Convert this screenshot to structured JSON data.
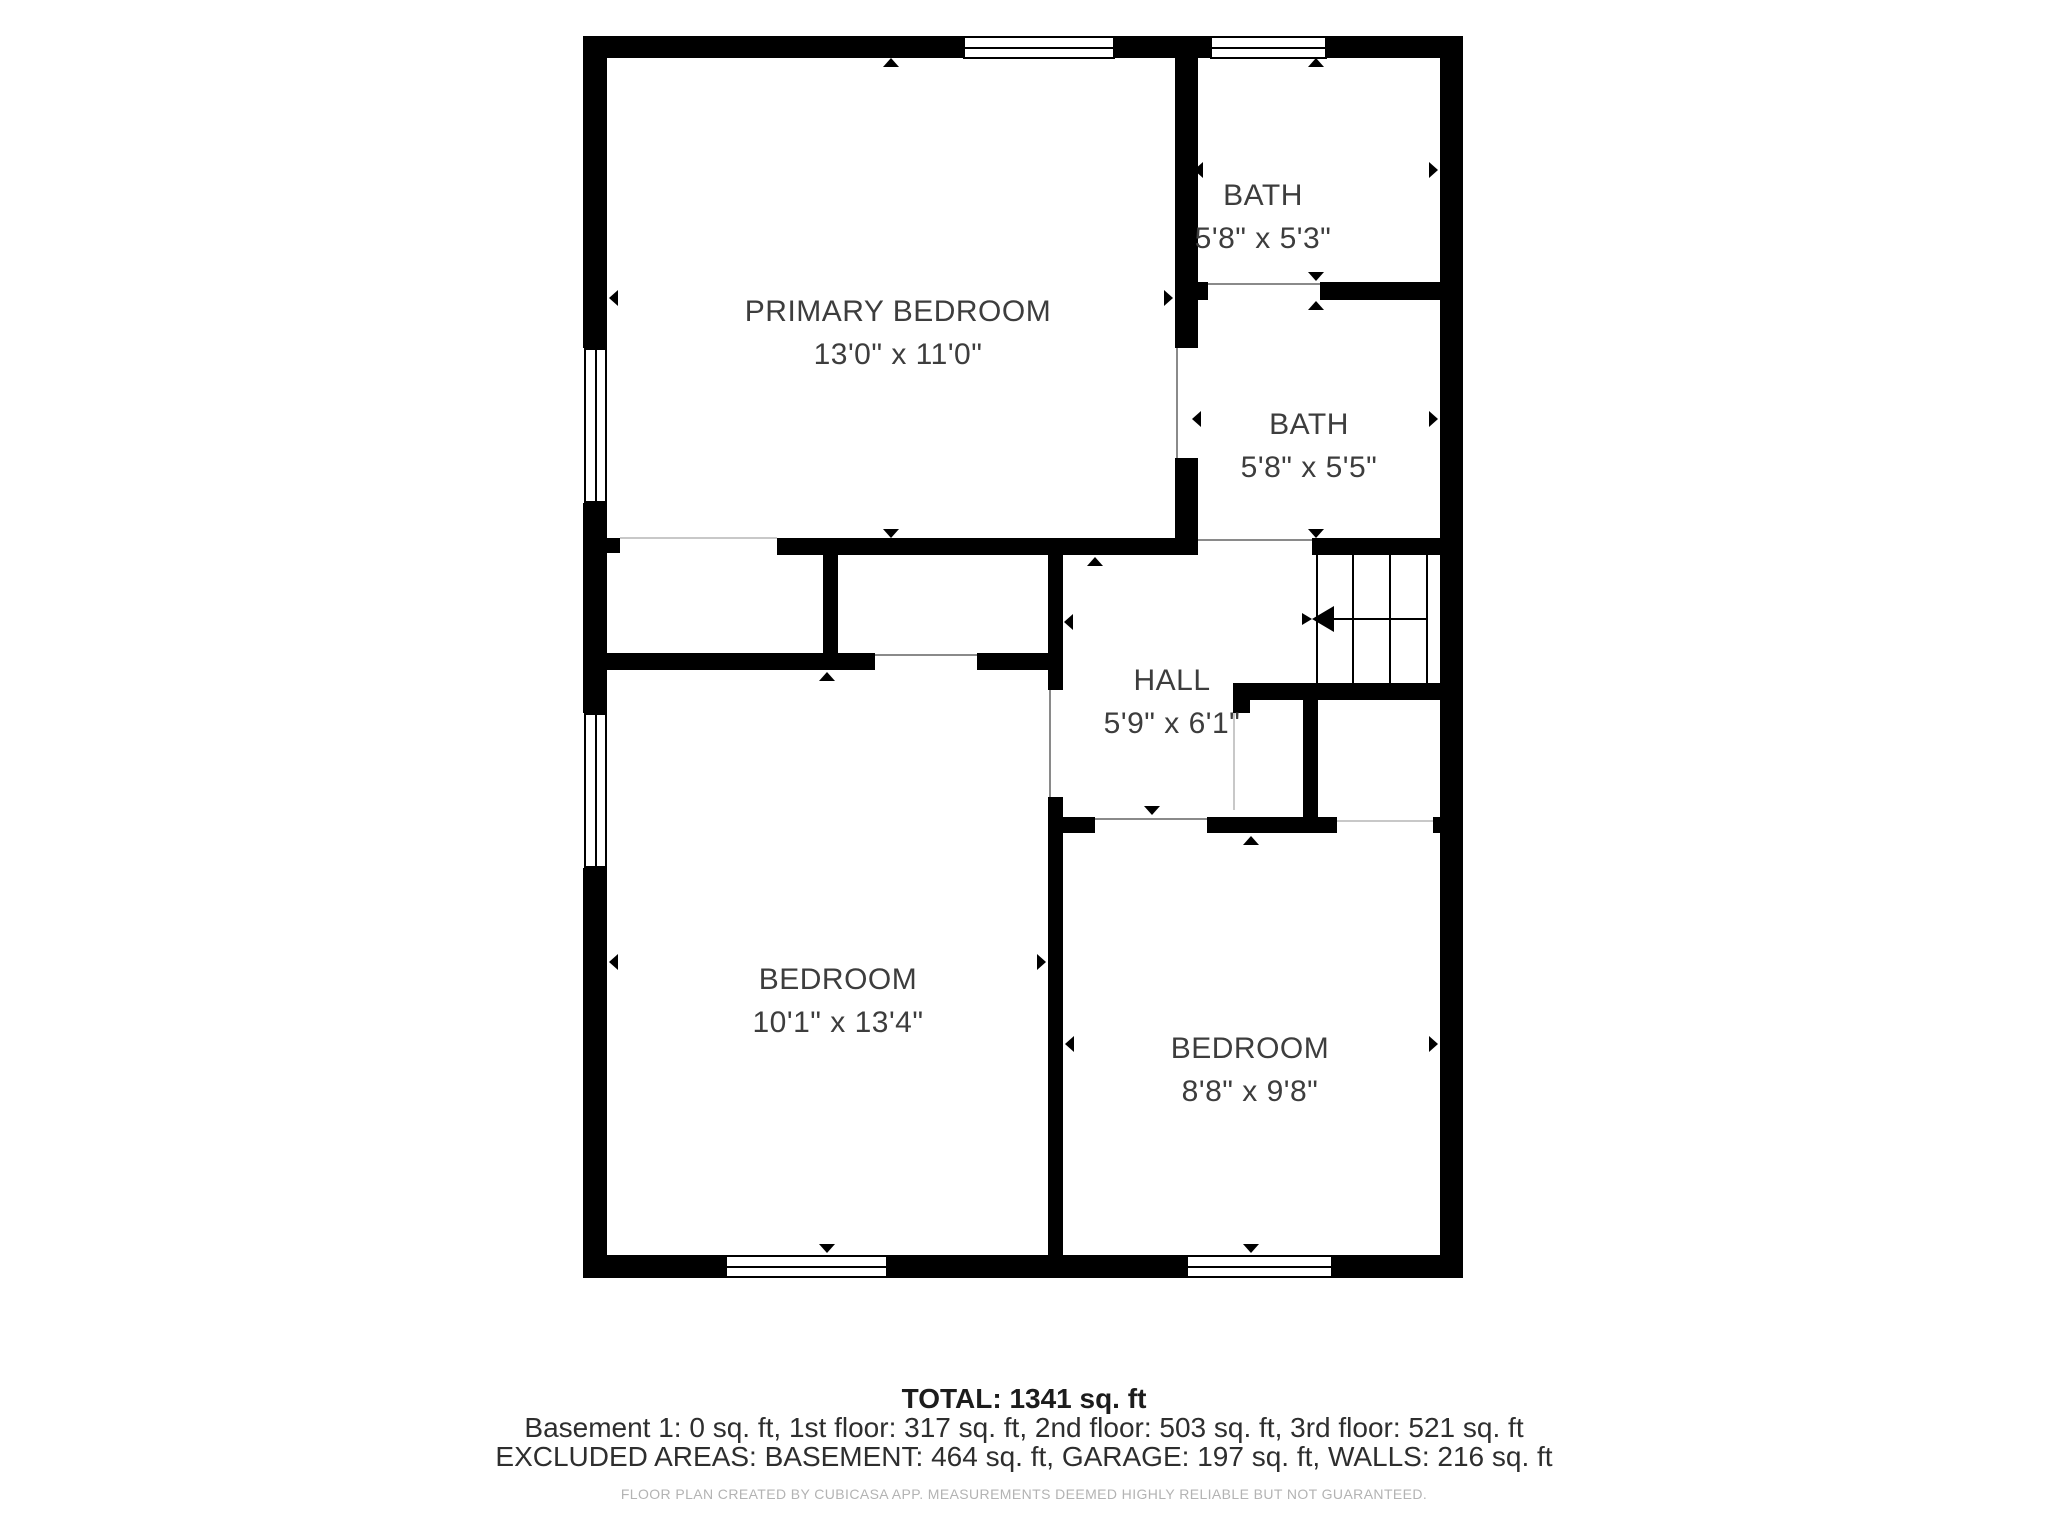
{
  "floor_plan": {
    "rooms": [
      {
        "id": "primary-bedroom",
        "name": "PRIMARY BEDROOM",
        "dimensions": "13'0\" x 11'0\""
      },
      {
        "id": "bath-1",
        "name": "BATH",
        "dimensions": "5'8\" x 5'3\""
      },
      {
        "id": "bath-2",
        "name": "BATH",
        "dimensions": "5'8\" x 5'5\""
      },
      {
        "id": "hall",
        "name": "HALL",
        "dimensions": "5'9\" x 6'1\""
      },
      {
        "id": "bedroom-1",
        "name": "BEDROOM",
        "dimensions": "10'1\" x 13'4\""
      },
      {
        "id": "bedroom-2",
        "name": "BEDROOM",
        "dimensions": "8'8\" x 9'8\""
      }
    ],
    "summary": {
      "total": "TOTAL: 1341 sq. ft",
      "floors": "Basement 1: 0 sq. ft, 1st floor: 317 sq. ft, 2nd floor: 503 sq. ft, 3rd floor: 521 sq. ft",
      "excluded": "EXCLUDED AREAS: BASEMENT: 464 sq. ft, GARAGE: 197 sq. ft, WALLS: 216 sq. ft"
    },
    "disclaimer": "FLOOR PLAN CREATED BY CUBICASA APP. MEASUREMENTS DEEMED HIGHLY RELIABLE BUT NOT GUARANTEED.",
    "colors": {
      "wall": "#000000",
      "background": "#ffffff",
      "label_text": "#3d3d3d",
      "disclaimer_text": "#b3b3b3",
      "boundary_line": "#c8c8c8"
    }
  }
}
